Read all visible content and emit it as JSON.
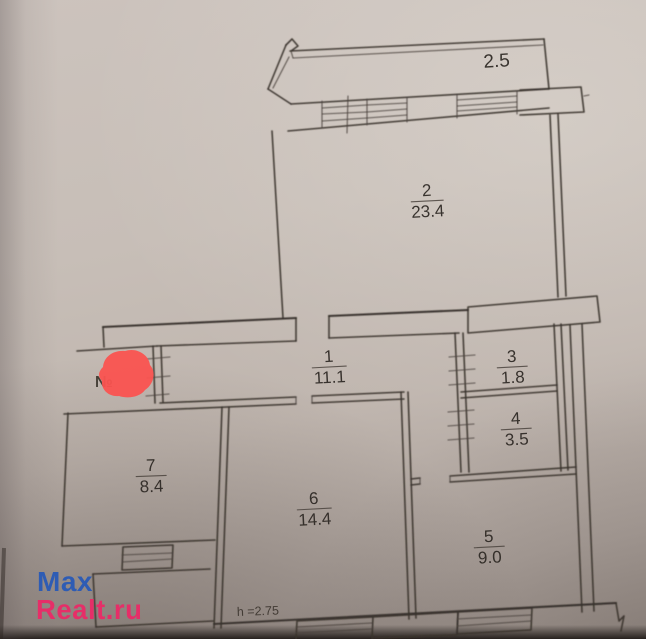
{
  "photo": {
    "paper_color": "#c3bab3",
    "ink_color": "#3a332e"
  },
  "plan": {
    "rooms": {
      "balcony": {
        "area": "2.5"
      },
      "r1": {
        "num": "1",
        "area": "11.1"
      },
      "r2": {
        "num": "2",
        "area": "23.4"
      },
      "r3": {
        "num": "3",
        "area": "1.8"
      },
      "r4": {
        "num": "4",
        "area": "3.5"
      },
      "r5": {
        "num": "5",
        "area": "9.0"
      },
      "r6": {
        "num": "6",
        "area": "14.4"
      },
      "r7": {
        "num": "7",
        "area": "8.4"
      }
    },
    "ceiling_height_label": "h =2.75",
    "number_sign": "№",
    "redaction_color": "#fa5350"
  },
  "watermark": {
    "line1": "Max",
    "line2": "Realt.ru",
    "color1": "#2e5cb4",
    "color2": "#e62e68"
  }
}
